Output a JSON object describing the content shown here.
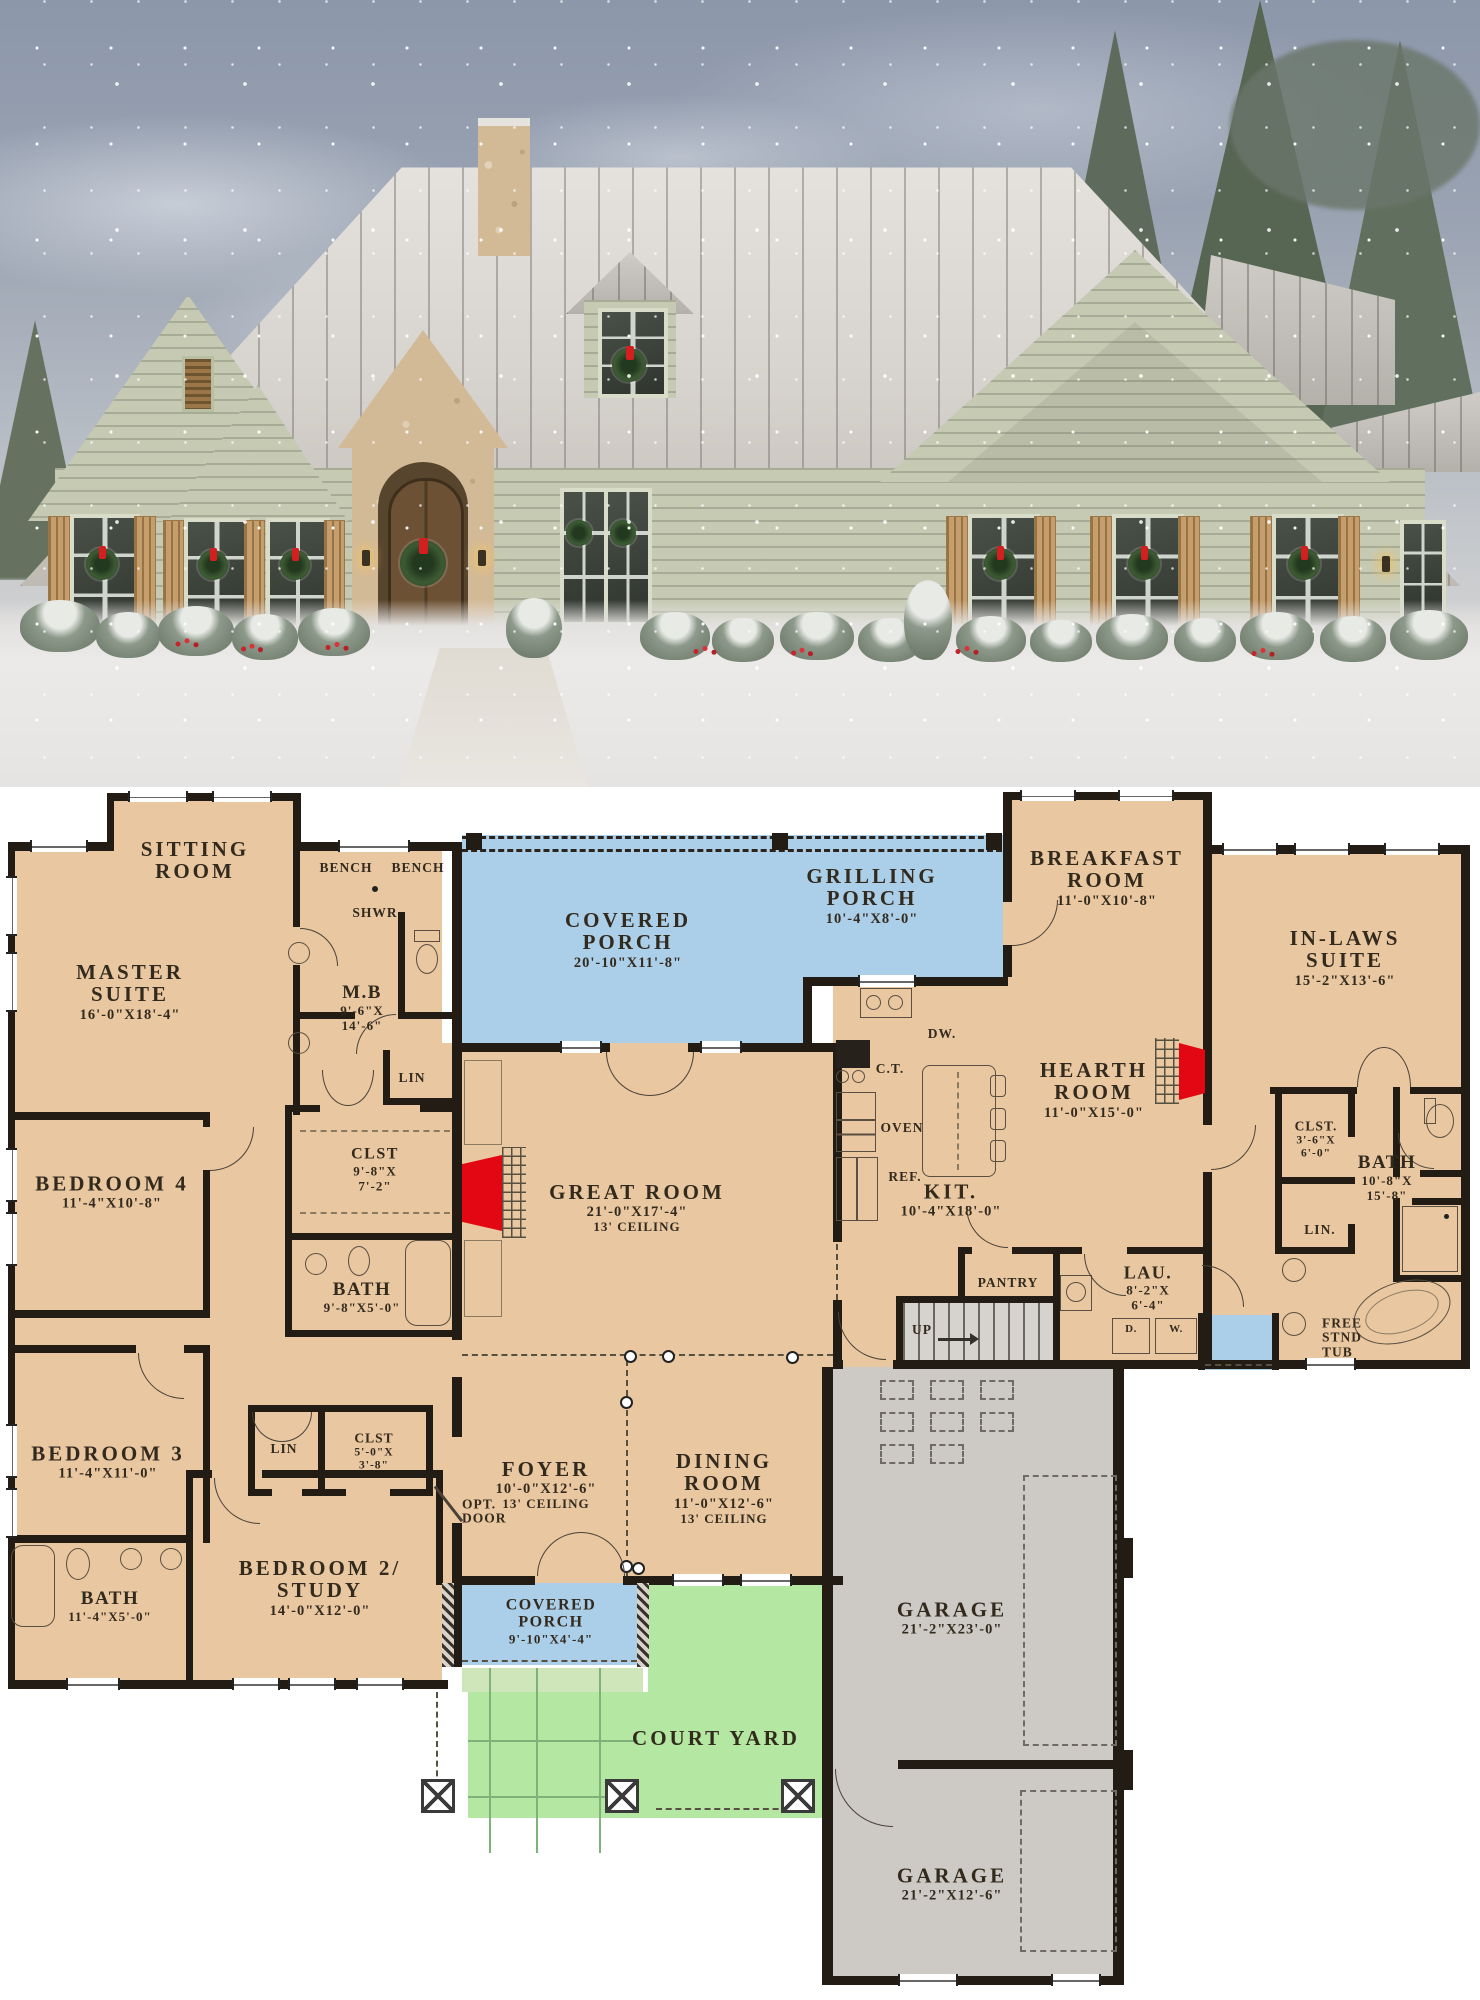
{
  "colors": {
    "floor_tan": "#e8c7a1",
    "porch_blue": "#abcfe9",
    "courtyard_green": "#b3e7a2",
    "walkway_green": "#cfe6bb",
    "garage_gray": "#cdcac5",
    "wall_black": "#221c15",
    "fireplace_red": "#e30613",
    "label_ink": "#332a1e"
  },
  "photo_palette": {
    "siding_sage": "#c6cab3",
    "roof_snow": "#dcd8d3",
    "stone": "#d3ba97",
    "sky": "#8c97aa",
    "wreath": "#3c5a33",
    "bow_red": "#d31f1f"
  },
  "rooms": {
    "sitting": {
      "name": "SITTING\nROOM"
    },
    "master": {
      "name": "MASTER\nSUITE",
      "dims": "16'-0\"X18'-4\""
    },
    "bench_l": {
      "name": "BENCH"
    },
    "bench_r": {
      "name": "BENCH"
    },
    "shwr": {
      "name": "SHWR"
    },
    "mb": {
      "name": "M.B",
      "dims": "9'-6\"X\n14'-6\""
    },
    "lin_mb": {
      "name": "LIN"
    },
    "clst_master": {
      "name": "CLST",
      "dims": "9'-8\"X\n7'-2\""
    },
    "bedroom4": {
      "name": "BEDROOM 4",
      "dims": "11'-4\"X10'-8\""
    },
    "bath_hall": {
      "name": "BATH",
      "dims": "9'-8\"X5'-0\""
    },
    "bedroom3": {
      "name": "BEDROOM 3",
      "dims": "11'-4\"X11'-0\""
    },
    "lin_b3": {
      "name": "LIN"
    },
    "clst_b3": {
      "name": "CLST",
      "dims": "5'-0\"X\n3'-8\""
    },
    "opt_door": {
      "name": "OPT.\nDOOR"
    },
    "bath_front": {
      "name": "BATH",
      "dims": "11'-4\"X5'-0\""
    },
    "bedroom2": {
      "name": "BEDROOM 2/\nSTUDY",
      "dims": "14'-0\"X12'-0\""
    },
    "covered_porch_rear": {
      "name": "COVERED\nPORCH",
      "dims": "20'-10\"X11'-8\""
    },
    "grilling_porch": {
      "name": "GRILLING\nPORCH",
      "dims": "10'-4\"X8'-0\""
    },
    "breakfast": {
      "name": "BREAKFAST\nROOM",
      "dims": "11'-0\"X10'-8\""
    },
    "inlaws": {
      "name": "IN-LAWS SUITE",
      "dims": "15'-2\"X13'-6\""
    },
    "hearth": {
      "name": "HEARTH\nROOM",
      "dims": "11'-0\"X15'-0\""
    },
    "great": {
      "name": "GREAT ROOM",
      "dims": "21'-0\"X17'-4\"",
      "note": "13' CEILING"
    },
    "kitchen": {
      "name": "KIT.",
      "dims": "10'-4\"X18'-0\""
    },
    "pantry": {
      "name": "PANTRY"
    },
    "laundry": {
      "name": "LAU.",
      "dims": "8'-2\"X\n6'-4\""
    },
    "foyer": {
      "name": "FOYER",
      "dims": "10'-0\"X12'-6\"",
      "note": "13' CEILING"
    },
    "dining": {
      "name": "DINING\nROOM",
      "dims": "11'-0\"X12'-6\"",
      "note": "13' CEILING"
    },
    "clst_inlaws": {
      "name": "CLST.",
      "dims": "3'-6\"X\n6'-0\""
    },
    "bath_inlaws": {
      "name": "BATH",
      "dims": "10'-8\"X\n15'-8\""
    },
    "lin_inlaws": {
      "name": "LIN."
    },
    "tub": {
      "name": "FREE\nSTND\nTUB"
    },
    "covered_porch_front": {
      "name": "COVERED\nPORCH",
      "dims": "9'-10\"X4'-4\""
    },
    "courtyard": {
      "name": "COURT YARD"
    },
    "garage1": {
      "name": "GARAGE",
      "dims": "21'-2\"X23'-0\""
    },
    "garage2": {
      "name": "GARAGE",
      "dims": "21'-2\"X12'-6\""
    }
  },
  "appl": {
    "dw": "DW.",
    "ct": "C.T.",
    "oven": "OVEN",
    "ref": "REF.",
    "dryer": "D.",
    "washer": "W.",
    "up": "UP"
  }
}
